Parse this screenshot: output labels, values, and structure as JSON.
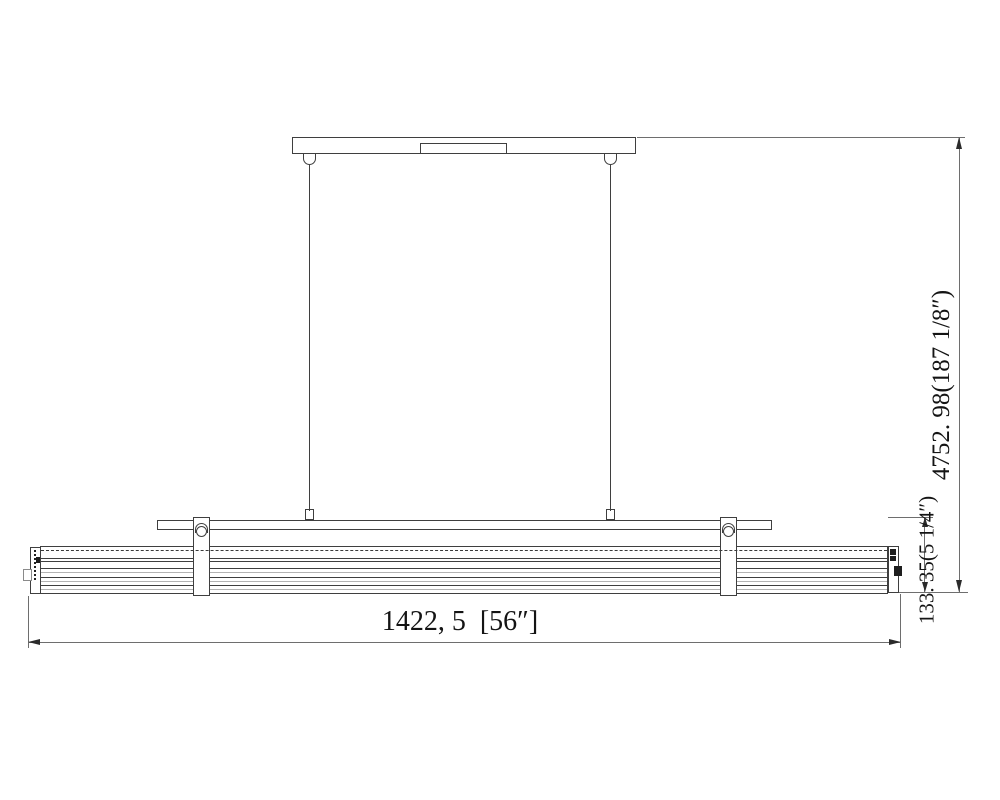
{
  "drawing": {
    "type": "linear-pendant-fixture-installation-drawing",
    "dimension_labels": {
      "overall_width": "1422, 5  [56″]",
      "overall_hanging_height": "4752. 98(187 1/8″)",
      "fixture_body_height": "133. 35(5 1/4″)"
    },
    "colors": {
      "background": "#ffffff",
      "structure_line": "#3f3f3f",
      "dimension_line": "#6e6e6e",
      "light_detail_line": "#b3b3b3",
      "text": "#141414"
    }
  }
}
